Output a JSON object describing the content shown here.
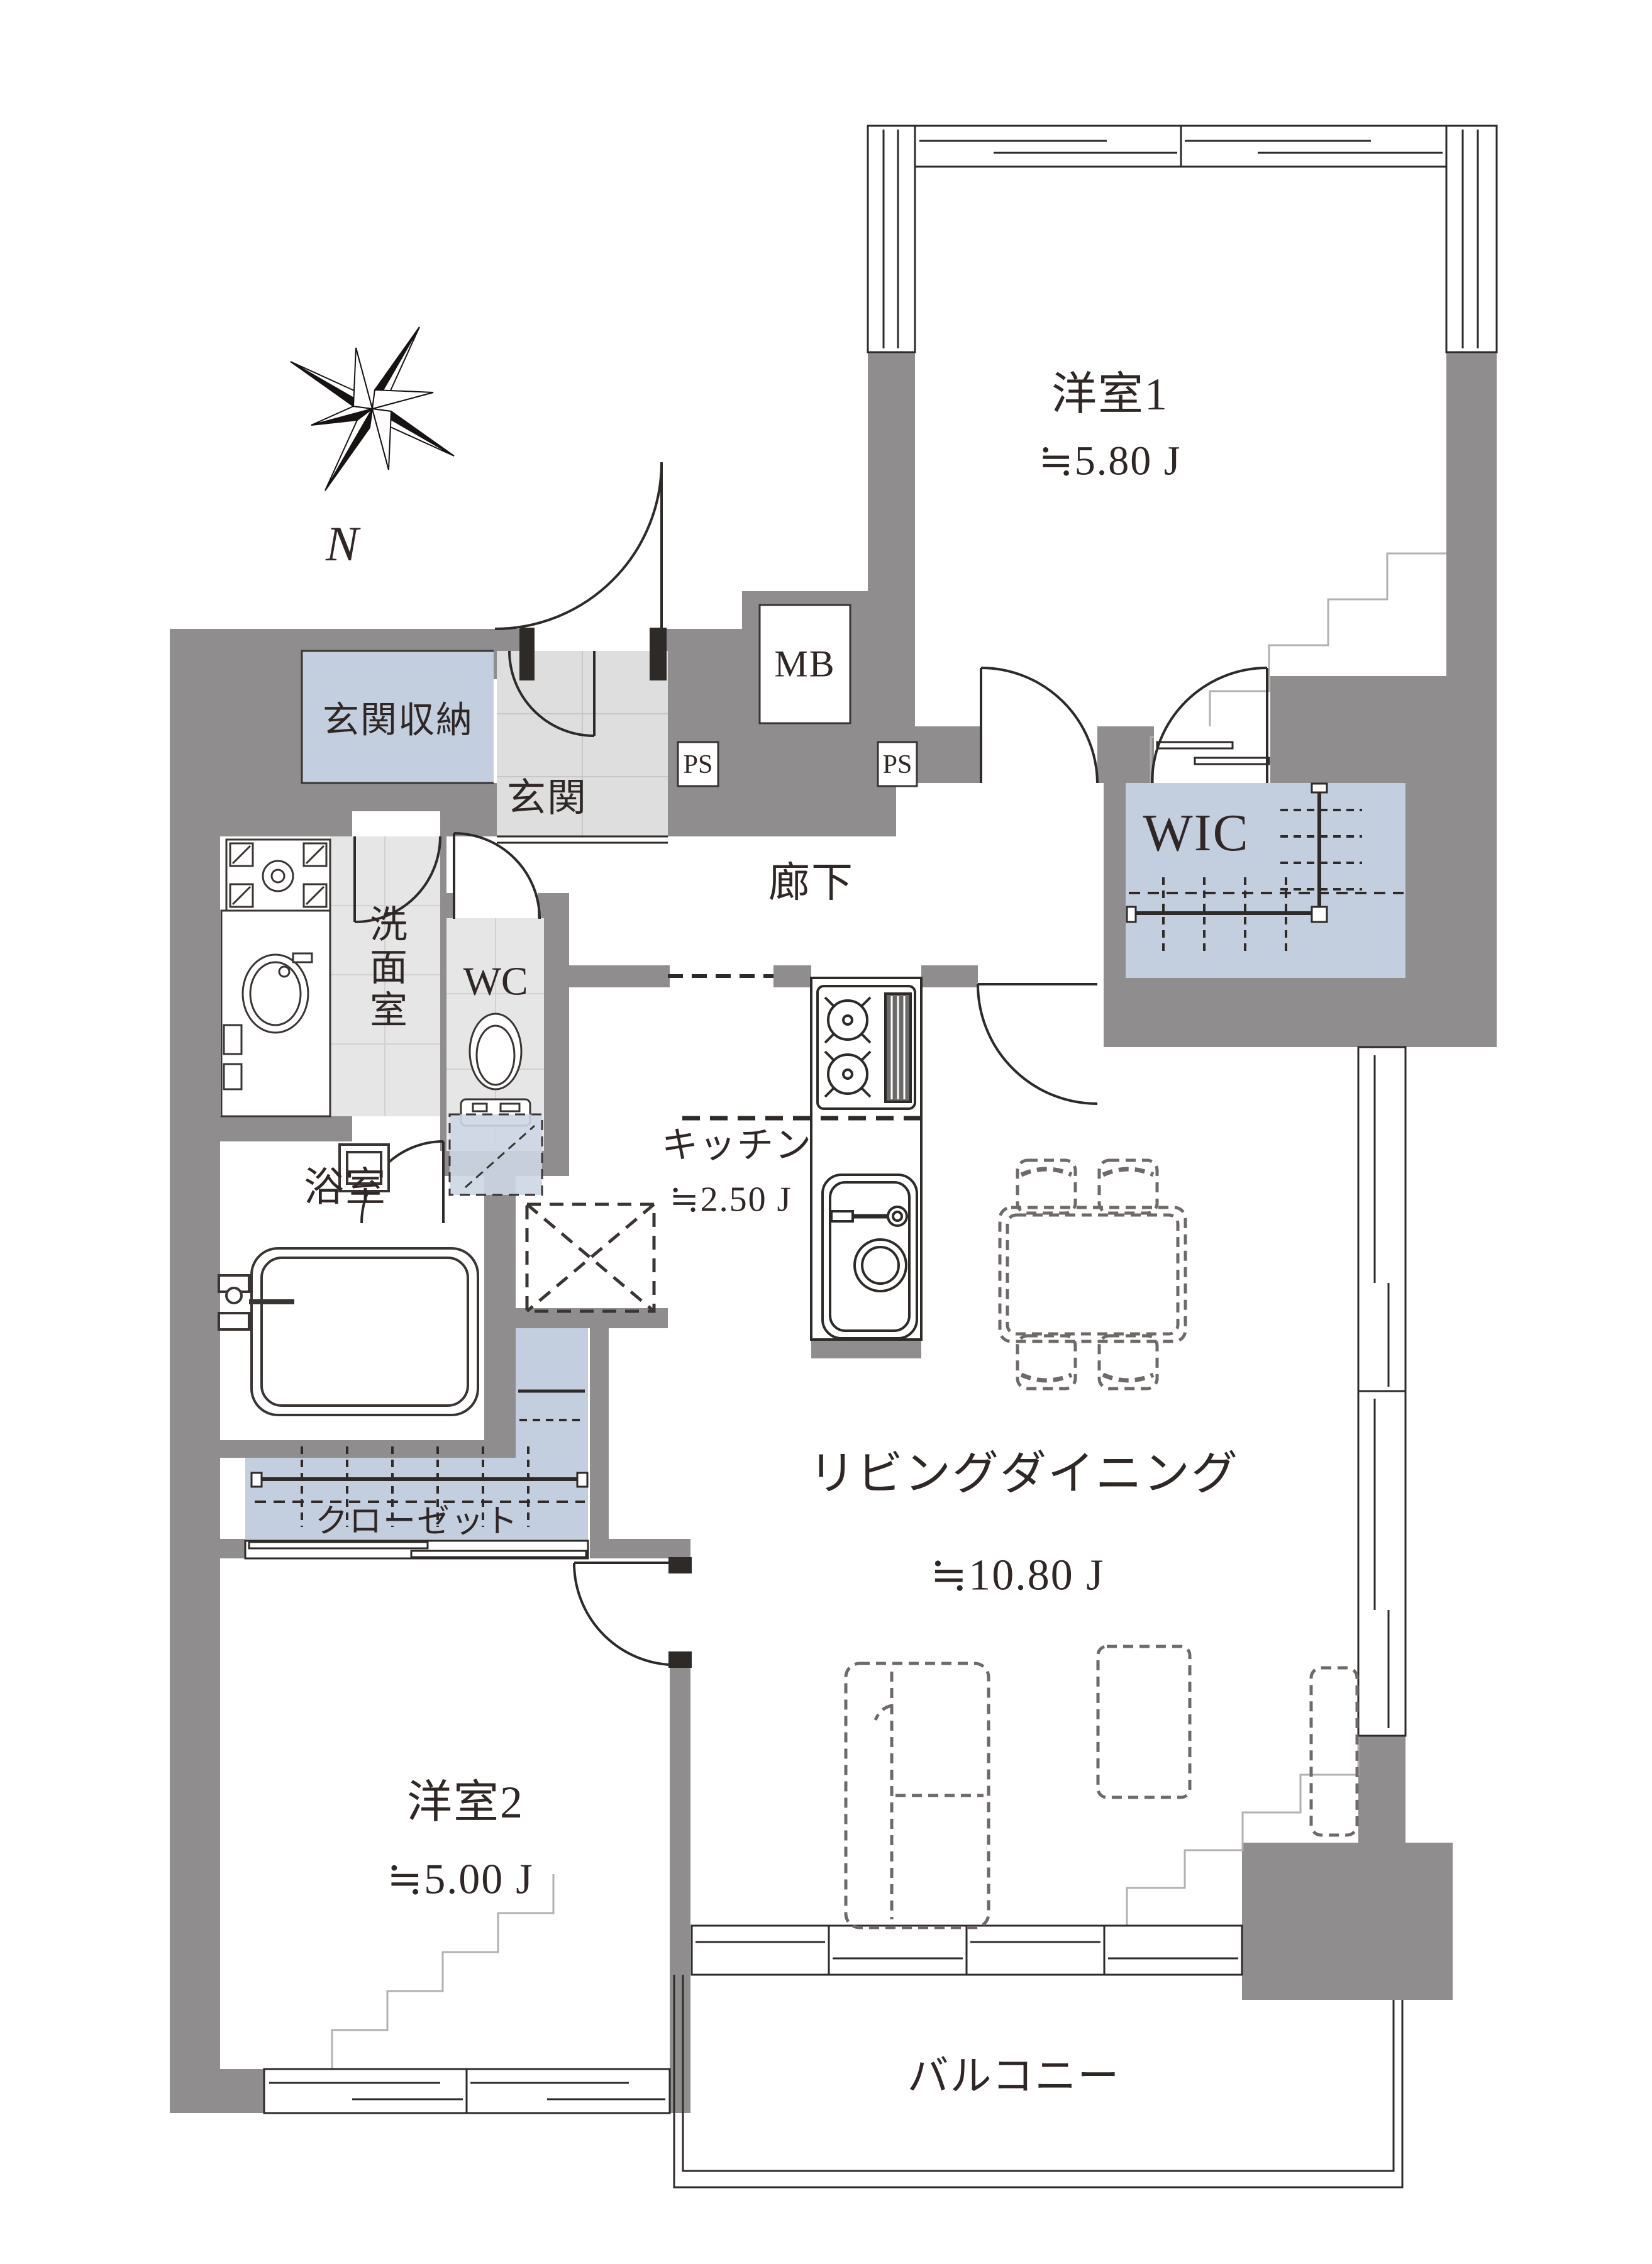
{
  "compass": {
    "label": "N"
  },
  "rooms": {
    "western1": {
      "label": "洋室1",
      "area": "≒5.80 J"
    },
    "living_dining": {
      "label": "リビングダイニング",
      "area": "≒10.80 J"
    },
    "western2": {
      "label": "洋室2",
      "area": "≒5.00 J"
    },
    "kitchen": {
      "label": "キッチン",
      "area": "≒2.50 J"
    },
    "hallway": {
      "label": "廊下"
    },
    "entrance": {
      "label": "玄関"
    },
    "entrance_storage": {
      "label": "玄関収納"
    },
    "washroom": {
      "label": "洗面室"
    },
    "toilet": {
      "label": "WC"
    },
    "bathroom": {
      "label": "浴室"
    },
    "wic": {
      "label": "WIC"
    },
    "closet": {
      "label": "クローゼット"
    },
    "balcony": {
      "label": "バルコニー"
    },
    "meter_box": {
      "label": "MB"
    },
    "pipe_space_left": {
      "label": "PS"
    },
    "pipe_space_right": {
      "label": "PS"
    }
  },
  "icons": [
    "compass-rose-icon",
    "stove-icon",
    "kitchen-sink-icon",
    "toilet-icon",
    "bathtub-icon",
    "laundry-pan-icon",
    "vanity-basin-icon",
    "dining-set-icon",
    "sofa-icon",
    "coffee-table-icon",
    "tv-board-icon",
    "door-swing-icon",
    "sliding-window-icon",
    "hanger-pole-icon",
    "refrigerator-space-icon"
  ],
  "colors": {
    "wall": "#8f8d8e",
    "storage_fill": "#c3cedf",
    "storage_dashed_fill": "#ccd6e3",
    "entrance_floor": "#dedede",
    "tile_floor": "#e7e6e6",
    "line": "#3a3432",
    "step_line": "#b4b0af",
    "furniture_dash": "#6f6a68"
  }
}
